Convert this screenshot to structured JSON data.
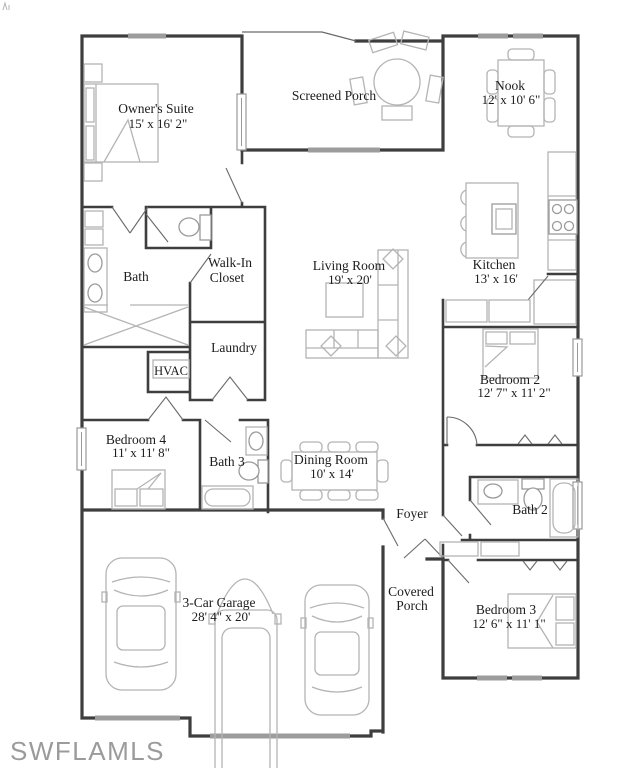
{
  "page": {
    "type": "residential-floor-plan",
    "background": "#ffffff"
  },
  "watermark": {
    "text": "SWFLAMLS",
    "color": "#9b9b9b"
  },
  "colors": {
    "wall": "#3e3e3e",
    "door_swing": "#6a6a6a",
    "furniture": "#b4b4b4",
    "fixture": "#9a9a9a",
    "window_marker": "#9c9c9c",
    "label": "#1c1c1c"
  },
  "rooms": {
    "owners_suite": {
      "name": "Owner's Suite",
      "dims": "15' x 16' 2\""
    },
    "screened_porch": {
      "name": "Screened Porch"
    },
    "nook": {
      "name": "Nook",
      "dims": "12' x 10' 6\""
    },
    "bath": {
      "name": "Bath"
    },
    "walk_in_closet": {
      "line1": "Walk-In",
      "line2": "Closet"
    },
    "laundry": {
      "name": "Laundry"
    },
    "hvac": {
      "name": "HVAC"
    },
    "living_room": {
      "name": "Living Room",
      "dims": "19' x 20'"
    },
    "kitchen": {
      "name": "Kitchen",
      "dims": "13' x 16'"
    },
    "bedroom_2": {
      "name": "Bedroom 2",
      "dims": "12' 7\" x 11' 2\""
    },
    "bedroom_4": {
      "name": "Bedroom 4",
      "dims": "11' x 11' 8\""
    },
    "bath_3": {
      "name": "Bath 3"
    },
    "dining_room": {
      "name": "Dining Room",
      "dims": "10' x 14'"
    },
    "foyer": {
      "name": "Foyer"
    },
    "bath_2": {
      "name": "Bath 2"
    },
    "bedroom_3": {
      "name": "Bedroom 3",
      "dims": "12' 6\" x 11' 1\""
    },
    "garage": {
      "name": "3-Car Garage",
      "dims": "28' 4\" x 20'"
    },
    "covered_porch": {
      "line1": "Covered",
      "line2": "Porch"
    }
  },
  "icons": {
    "bed-icon": "rect outline with pillows and fold",
    "nightstand-icon": "small square",
    "sofa-icon": "L-shaped sectional outline",
    "coffee-table-icon": "square outline",
    "round-table-icon": "circle with 5 chairs",
    "dining-table-icon": "rectangle with 8 chairs",
    "nook-table-icon": "rectangle with 6 chairs",
    "kitchen-island-icon": "rectangle with sink and 3 stools",
    "stove-icon": "rectangle with 4 burner circles",
    "toilet-icon": "tank and bowl ellipse",
    "sink-icon": "oval in counter",
    "bathtub-icon": "rounded rectangle",
    "shower-icon": "crossed X area",
    "car-icon": "top view car outline",
    "window-marker": "gray wall segment",
    "door-swing": "thin diagonal leaf"
  }
}
